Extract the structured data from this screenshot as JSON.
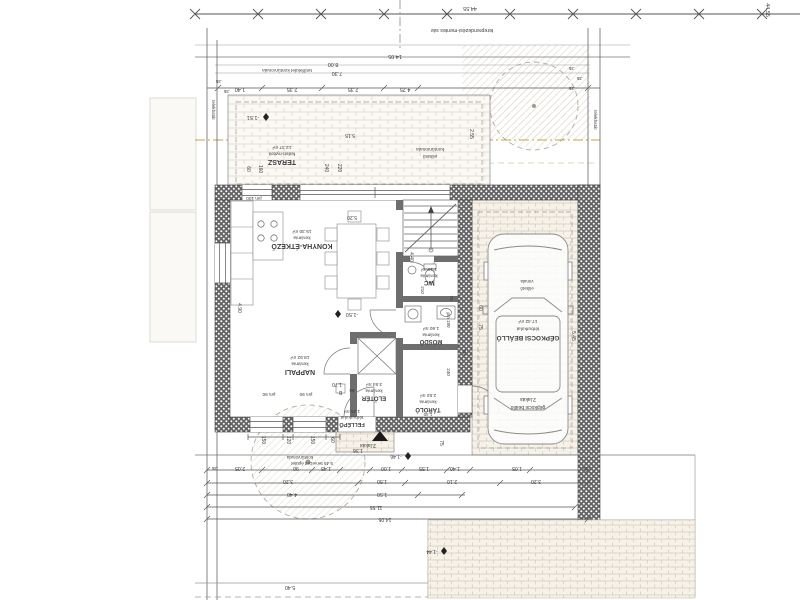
{
  "meta": {
    "drawing_type": "architectural floor plan (ground level, rotated 180°)",
    "language": "Hungarian"
  },
  "colors": {
    "background": "#ffffff",
    "line": "#4a4a4a",
    "thin_line": "#9a9a9a",
    "wall_dark": "#5f5f5f",
    "brick_line": "#d8d0c0",
    "hatch": "#d9d3c6",
    "accent_dashdot": "#cf9f3f",
    "text": "#3c3c3c",
    "marker": "#1a1a1a"
  },
  "rooms": [
    {
      "id": "terasz",
      "name": "TERASZ",
      "finish": "fedett-nyitott",
      "area": "12.37 m²",
      "cx": 282,
      "y_area": 146,
      "y_finish": 152.5,
      "y_name": 160,
      "name_size": 7
    },
    {
      "id": "konyha",
      "name": "KONYHA-ÉTKEZŐ",
      "finish": "kerámia",
      "area": "15.30 m²",
      "cx": 302,
      "y_area": 230,
      "y_finish": 236.5,
      "y_name": 244,
      "name_size": 7
    },
    {
      "id": "nappali",
      "name": "NAPPALI",
      "finish": "kerámia",
      "area": "18.52 m²",
      "cx": 300,
      "y_area": 356,
      "y_finish": 362.5,
      "y_name": 370,
      "name_size": 7
    },
    {
      "id": "eloter",
      "name": "ELŐTÉR",
      "finish": "kerámia",
      "area": "3.54 m²",
      "cx": 374,
      "y_area": 383,
      "y_finish": 389.5,
      "y_name": 396.5,
      "name_size": 6
    },
    {
      "id": "wc",
      "name": "WC",
      "finish": "kerámia",
      "area": "1.10 m²",
      "cx": 429,
      "y_area": 268,
      "y_finish": 274.5,
      "y_name": 281,
      "name_size": 6
    },
    {
      "id": "mosdo",
      "name": "MOSDÓ",
      "finish": "kerámia",
      "area": "1.60 m²",
      "cx": 431,
      "y_area": 327,
      "y_finish": 333.5,
      "y_name": 340,
      "name_size": 6
    },
    {
      "id": "tarolo",
      "name": "TÁROLÓ",
      "finish": "kerámia",
      "area": "2.52 m²",
      "cx": 428,
      "y_area": 394,
      "y_finish": 400.5,
      "y_name": 408,
      "name_size": 6
    },
    {
      "id": "fellepo",
      "name": "FELLÉPŐ",
      "finish": "térburkolat",
      "area": "1.35 m²",
      "cx": 352,
      "y_area": 410,
      "y_finish": 416,
      "y_name": 423,
      "name_size": 5.5
    },
    {
      "id": "gepkocsi",
      "name": "GÉPKOCSI BEÁLLÓ",
      "finish": "térburkolat",
      "area": "17.42 m²",
      "cx": 528,
      "y_area": 320,
      "y_finish": 327.5,
      "y_name": 336,
      "name_size": 6.5
    }
  ],
  "texts": [
    {
      "n": "site-length-dim",
      "t": "44.55",
      "x": 470,
      "y": 7,
      "r": 180,
      "s": 5.5
    },
    {
      "n": "site-length-dim-right",
      "t": "44.55",
      "x": 766,
      "y": 10,
      "r": 90,
      "s": 5.5
    },
    {
      "n": "setback-strip-note",
      "t": "tereprendezési-mentes sáv",
      "x": 462,
      "y": 29,
      "r": 180,
      "s": 5.2
    },
    {
      "n": "dim-top",
      "t": "14.05",
      "x": 395,
      "y": 55,
      "r": 180,
      "s": 5.5
    },
    {
      "n": "roof-contour-note",
      "t": "tetőfelület kontúrvonala",
      "x": 287,
      "y": 69,
      "r": 180,
      "s": 4.8
    },
    {
      "n": "dim-top",
      "t": "8.00",
      "x": 333,
      "y": 63,
      "r": 180,
      "s": 5.5
    },
    {
      "n": "dim-top",
      "t": "7.30",
      "x": 337,
      "y": 72,
      "r": 180,
      "s": 5.5
    },
    {
      "n": "dim-chain-top",
      "t": "1.40",
      "x": 240,
      "y": 88,
      "r": 180,
      "s": 5.5
    },
    {
      "n": "dim-chain-top",
      "t": "2.35",
      "x": 292,
      "y": 88,
      "r": 180,
      "s": 5.5
    },
    {
      "n": "dim-chain-top",
      "t": "2.35",
      "x": 353,
      "y": 88,
      "r": 180,
      "s": 5.5
    },
    {
      "n": "dim-chain-top",
      "t": "4.25",
      "x": 405,
      "y": 88,
      "r": 180,
      "s": 5.5
    },
    {
      "n": "dim-wall",
      "t": ".35",
      "x": 219,
      "y": 80,
      "r": 180,
      "s": 4.5
    },
    {
      "n": "dim-wall",
      "t": ".35",
      "x": 227,
      "y": 90,
      "r": 180,
      "s": 4.5
    },
    {
      "n": "dim-wall",
      "t": ".35",
      "x": 572,
      "y": 67,
      "r": 180,
      "s": 4.5
    },
    {
      "n": "dim-wall",
      "t": ".35",
      "x": 580,
      "y": 77,
      "r": 180,
      "s": 4.5
    },
    {
      "n": "dim-wall",
      "t": ".35",
      "x": 572,
      "y": 87,
      "r": 180,
      "s": 4.5
    },
    {
      "n": "property-line-label-left",
      "t": "telekhatár",
      "x": 212,
      "y": 110,
      "r": 90,
      "s": 4.5
    },
    {
      "n": "property-line-label-right",
      "t": "telekhatár",
      "x": 594,
      "y": 120,
      "r": 90,
      "s": 4.5
    },
    {
      "n": "spot-elevation",
      "t": "-1.51",
      "x": 253,
      "y": 116,
      "r": 180,
      "s": 5.5
    },
    {
      "n": "dim-terrace",
      "t": "5.15",
      "x": 350,
      "y": 134,
      "r": 180,
      "s": 5
    },
    {
      "n": "canopy-contour-note-2",
      "t": "előtető",
      "x": 430,
      "y": 155,
      "r": 180,
      "s": 4.8
    },
    {
      "n": "canopy-contour-note-1",
      "t": "kontúrvonala",
      "x": 430,
      "y": 148,
      "r": 180,
      "s": 4.8
    },
    {
      "n": "dim-terrace",
      "t": "2.55",
      "x": 470,
      "y": 134,
      "r": 90,
      "s": 5
    },
    {
      "n": "dim-window",
      "t": "60",
      "x": 247,
      "y": 169,
      "r": 90,
      "s": 5
    },
    {
      "n": "dim-window",
      "t": "160",
      "x": 259,
      "y": 169,
      "r": 90,
      "s": 5
    },
    {
      "n": "dim-window",
      "t": "240",
      "x": 325,
      "y": 168,
      "r": 90,
      "s": 5
    },
    {
      "n": "dim-window",
      "t": "220",
      "x": 338,
      "y": 168,
      "r": 90,
      "s": 5
    },
    {
      "n": "parapet-mark",
      "t": "pm 100",
      "x": 254,
      "y": 197,
      "r": 180,
      "s": 4.6
    },
    {
      "n": "dim-room",
      "t": "5.20",
      "x": 352,
      "y": 216,
      "r": 180,
      "s": 5
    },
    {
      "n": "dim-room",
      "t": "4.90",
      "x": 238,
      "y": 308,
      "r": 90,
      "s": 5
    },
    {
      "n": "spot-elevation",
      "t": "-1.50",
      "x": 352,
      "y": 313,
      "r": 180,
      "s": 5.5
    },
    {
      "n": "dim-room",
      "t": "1.70",
      "x": 337,
      "y": 383,
      "r": 180,
      "s": 5
    },
    {
      "n": "dim-stair",
      "t": "4.40",
      "x": 410,
      "y": 257,
      "r": 90,
      "s": 5
    },
    {
      "n": "dim-stair",
      "t": "210",
      "x": 421,
      "y": 290,
      "r": 90,
      "s": 4.5
    },
    {
      "n": "dim-stair",
      "t": "75",
      "x": 450,
      "y": 298,
      "r": 90,
      "s": 4.5
    },
    {
      "n": "parapet-mark",
      "t": "pm 180",
      "x": 447,
      "y": 320,
      "r": 90,
      "s": 4.5
    },
    {
      "n": "dim-room",
      "t": "240",
      "x": 447,
      "y": 372,
      "r": 90,
      "s": 4.5
    },
    {
      "n": "dim-room",
      "t": "90",
      "x": 463,
      "y": 352,
      "r": 90,
      "s": 4.5
    },
    {
      "n": "dim-room",
      "t": "1.40",
      "x": 428,
      "y": 413,
      "r": 180,
      "s": 4.5
    },
    {
      "n": "dim-carport",
      "t": "60",
      "x": 479,
      "y": 308,
      "r": 90,
      "s": 5
    },
    {
      "n": "dim-carport",
      "t": "75",
      "x": 479,
      "y": 327,
      "r": 90,
      "s": 5
    },
    {
      "n": "dim-carport",
      "t": "5.45",
      "x": 572,
      "y": 336,
      "r": 90,
      "s": 5
    },
    {
      "n": "carport-unit-label-2",
      "t": "2.lakás",
      "x": 528,
      "y": 398,
      "r": 180,
      "s": 5
    },
    {
      "n": "carport-unit-label-1",
      "t": "gépkocsi beálló",
      "x": 528,
      "y": 406,
      "r": 180,
      "s": 5
    },
    {
      "n": "canopy-line-note-2",
      "t": "vonala",
      "x": 527,
      "y": 280,
      "r": 180,
      "s": 4.4
    },
    {
      "n": "canopy-line-note-1",
      "t": "előtető",
      "x": 527,
      "y": 287,
      "r": 180,
      "s": 4.4
    },
    {
      "n": "entrance-unit-label",
      "t": "2.lakás",
      "x": 368,
      "y": 444,
      "r": 180,
      "s": 5
    },
    {
      "n": "door-tag-letter",
      "t": "B",
      "x": 340.5,
      "y": 391,
      "r": 180,
      "s": 5
    },
    {
      "n": "door-tag-width",
      "t": "90",
      "x": 352,
      "y": 389,
      "r": 180,
      "s": 4.5
    },
    {
      "n": "dim-window",
      "t": "150",
      "x": 262,
      "y": 440,
      "r": 90,
      "s": 5
    },
    {
      "n": "dim-window",
      "t": "120",
      "x": 287,
      "y": 440,
      "r": 90,
      "s": 5
    },
    {
      "n": "dim-window",
      "t": "150",
      "x": 311,
      "y": 440,
      "r": 90,
      "s": 5
    },
    {
      "n": "dim-window",
      "t": "60",
      "x": 331,
      "y": 440,
      "r": 90,
      "s": 5
    },
    {
      "n": "dim-window",
      "t": "75",
      "x": 440,
      "y": 443,
      "r": 90,
      "s": 5
    },
    {
      "n": "parapet-mark",
      "t": "pm 90",
      "x": 269,
      "y": 393,
      "r": 180,
      "s": 4.6
    },
    {
      "n": "parapet-mark",
      "t": "pm 90",
      "x": 306,
      "y": 393,
      "r": 180,
      "s": 4.6
    },
    {
      "n": "dim-bottom",
      "t": "1.36",
      "x": 358,
      "y": 449,
      "r": 180,
      "s": 5
    },
    {
      "n": "spot-elevation",
      "t": "-1.46",
      "x": 396,
      "y": 455,
      "r": 180,
      "s": 5
    },
    {
      "n": "building-distance-note-2",
      "t": "5.45 tervezett épület",
      "x": 312,
      "y": 462,
      "r": 180,
      "s": 4.6
    },
    {
      "n": "building-distance-note-1",
      "t": "kontúrvonala",
      "x": 300,
      "y": 456,
      "r": 180,
      "s": 4.6
    },
    {
      "n": "dim-chain-a",
      "t": "2.05",
      "x": 240,
      "y": 467,
      "r": 180,
      "s": 5.2
    },
    {
      "n": "dim-chain-a",
      "t": "90",
      "x": 296,
      "y": 467,
      "r": 180,
      "s": 5.2
    },
    {
      "n": "dim-chain-a",
      "t": "1.45",
      "x": 326,
      "y": 467,
      "r": 180,
      "s": 5.2
    },
    {
      "n": "dim-chain-a",
      "t": "1.00",
      "x": 386,
      "y": 467,
      "r": 180,
      "s": 5.2
    },
    {
      "n": "dim-chain-a",
      "t": "1.55",
      "x": 424,
      "y": 467,
      "r": 180,
      "s": 5.2
    },
    {
      "n": "dim-chain-a",
      "t": "1.40",
      "x": 455,
      "y": 467,
      "r": 180,
      "s": 5.2
    },
    {
      "n": "dim-chain-a",
      "t": "1.05",
      "x": 517,
      "y": 467,
      "r": 180,
      "s": 5.2
    },
    {
      "n": "dim-chain-a",
      "t": ".35",
      "x": 215,
      "y": 467,
      "r": 180,
      "s": 4.5
    },
    {
      "n": "dim-chain-a",
      "t": ".35",
      "x": 586,
      "y": 467,
      "r": 180,
      "s": 4.5
    },
    {
      "n": "dim-chain-b",
      "t": "3.20",
      "x": 288,
      "y": 480,
      "r": 180,
      "s": 5.2
    },
    {
      "n": "dim-chain-b",
      "t": "1.50",
      "x": 382,
      "y": 480,
      "r": 180,
      "s": 5.2
    },
    {
      "n": "dim-chain-b",
      "t": "2.10",
      "x": 452,
      "y": 480,
      "r": 180,
      "s": 5.2
    },
    {
      "n": "dim-chain-b",
      "t": "3.20",
      "x": 536,
      "y": 480,
      "r": 180,
      "s": 5.2
    },
    {
      "n": "dim-chain-c",
      "t": "4.40",
      "x": 292,
      "y": 493,
      "r": 180,
      "s": 5.2
    },
    {
      "n": "dim-chain-c",
      "t": "1.50",
      "x": 382,
      "y": 493,
      "r": 180,
      "s": 5.2
    },
    {
      "n": "dim-chain-d",
      "t": "11.55",
      "x": 376,
      "y": 506,
      "r": 180,
      "s": 5.2
    },
    {
      "n": "dim-chain-e",
      "t": "14.05",
      "x": 385,
      "y": 518,
      "r": 180,
      "s": 5.2
    },
    {
      "n": "dim-bottom",
      "t": "5.40",
      "x": 290,
      "y": 586,
      "r": 180,
      "s": 5.2
    },
    {
      "n": "spot-elevation",
      "t": "-1.44",
      "x": 432,
      "y": 550,
      "r": 180,
      "s": 5
    }
  ]
}
